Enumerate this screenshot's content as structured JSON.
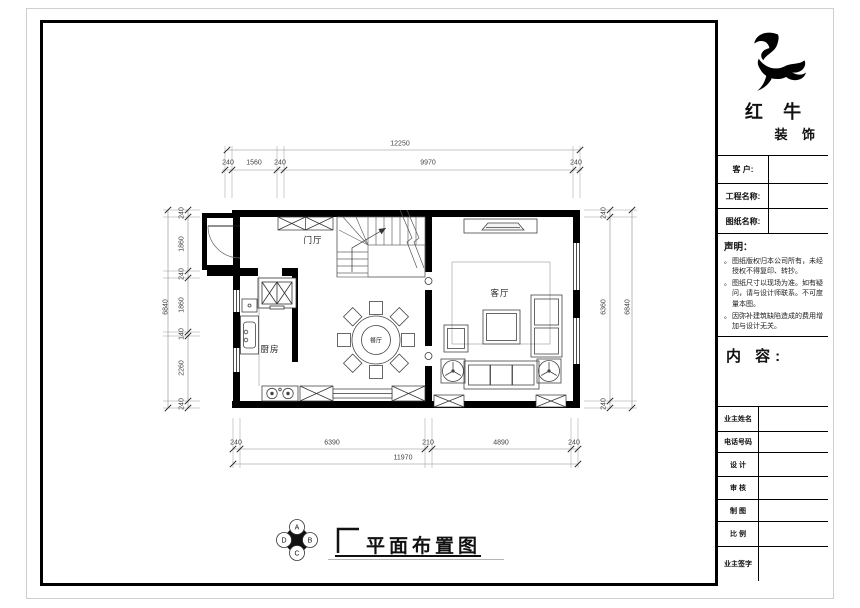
{
  "logo": {
    "brand_line1": "红 牛",
    "brand_line2": "装 饰"
  },
  "title_block": {
    "fields": [
      {
        "label": "客  户:",
        "value": ""
      },
      {
        "label": "工程名称:",
        "value": ""
      },
      {
        "label": "图纸名称:",
        "value": ""
      }
    ],
    "statement": {
      "heading": "声明：",
      "items": [
        "图纸版权归本公司所有，未经授权不得复印、转抄。",
        "图纸尺寸以现场为准。如有疑问，请与设计师联系。不可度量本图。",
        "因弥补建筑缺陷造成的费用增加与设计无关。"
      ]
    },
    "content_label": "内 容:",
    "info_rows": [
      {
        "label": "业主姓名",
        "value": ""
      },
      {
        "label": "电话号码",
        "value": ""
      },
      {
        "label": "设 计",
        "value": ""
      },
      {
        "label": "审 核",
        "value": ""
      },
      {
        "label": "制 图",
        "value": ""
      },
      {
        "label": "比 例",
        "value": ""
      },
      {
        "label": "业主签字",
        "value": ""
      }
    ]
  },
  "plan": {
    "rooms": [
      {
        "name": "门厅"
      },
      {
        "name": "厨房"
      },
      {
        "name": "餐厅"
      },
      {
        "name": "客厅"
      }
    ],
    "dimensions": {
      "top": {
        "overall": "12250",
        "segments": [
          "240",
          "1560",
          "240",
          "9970",
          "240"
        ]
      },
      "bottom": {
        "overall": "11970",
        "segments": [
          "240",
          "6390",
          "210",
          "4890",
          "240"
        ]
      },
      "left": {
        "overall": "6840",
        "segments": [
          "240",
          "1860",
          "240",
          "1860",
          "140",
          "2260",
          "240"
        ]
      },
      "right": {
        "overall": "6840",
        "segments": [
          "240",
          "6360",
          "240"
        ]
      }
    }
  },
  "footer": {
    "drawing_title": "平面布置图",
    "elevation_marker": {
      "top": "A",
      "right": "B",
      "bottom": "C",
      "left": "D"
    }
  }
}
